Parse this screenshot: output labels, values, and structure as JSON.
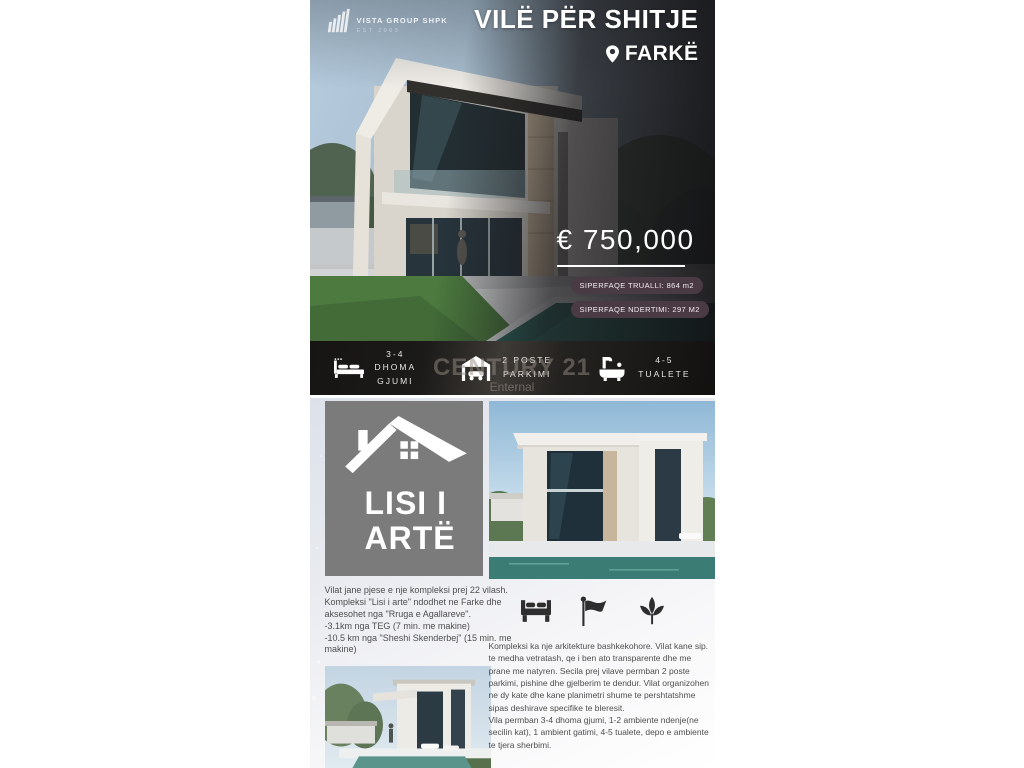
{
  "hero": {
    "logo": {
      "name": "VISTA GROUP SHPK",
      "est": "EST 2003"
    },
    "title": "VILË PËR SHITJE",
    "location": "FARKË",
    "price": "€ 750,000",
    "badges": [
      "SIPERFAQE TRUALLI: 864 m2",
      "SIPERFAQE NDERTIMI: 297 M2"
    ]
  },
  "features_bar": {
    "items": [
      {
        "icon": "bed-icon",
        "lines": [
          "3-4",
          "DHOMA",
          "GJUMI"
        ]
      },
      {
        "icon": "garage-icon",
        "lines": [
          "2 POSTE",
          "PARKIMI"
        ]
      },
      {
        "icon": "bathtub-icon",
        "lines": [
          "4-5",
          "TUALETE"
        ]
      }
    ],
    "watermark": {
      "line1": "CENTURY 21",
      "line2": "Enternal"
    }
  },
  "details": {
    "project_name_line1": "LISI I",
    "project_name_line2": "ARTË",
    "intro": "Vilat jane pjese e nje kompleksi prej 22 vilash. Kompleksi \"Lisi i arte\" ndodhet ne Farke dhe aksesohet nga \"Rruga e Agallareve\".",
    "distance1": "-3.1km nga TEG (7 min. me makine)",
    "distance2": "-10.5 km nga \"Sheshi Skenderbej\" (15 min. me makine)",
    "amenity_icons": [
      "bed-icon",
      "flag-icon",
      "leaf-icon"
    ],
    "description1": "Kompleksi ka nje arkitekture bashkekohore. Vilat kane sip. te medha vetratash, qe i ben ato transparente dhe me prane me natyren. Secila prej vilave permban 2 poste parkimi, pishine dhe gjelberim te dendur. Vilat organizohen ne dy kate dhe kane planimetri shume te pershtatshme sipas deshirave specifike te bleresit.",
    "description2": "Vila permban 3-4 dhoma gjumi, 1-2 ambiente ndenje(ne secilin kat), 1 ambient gatimi, 4-5 tualete, depo e ambiente te tjera sherbimi."
  },
  "colors": {
    "badge_bg": "#4a3a43",
    "box_gray": "#7b7b7b",
    "bar_dark": "#1b1a18",
    "pool_teal": "#2e6a63",
    "accent_white": "#ffffff"
  }
}
